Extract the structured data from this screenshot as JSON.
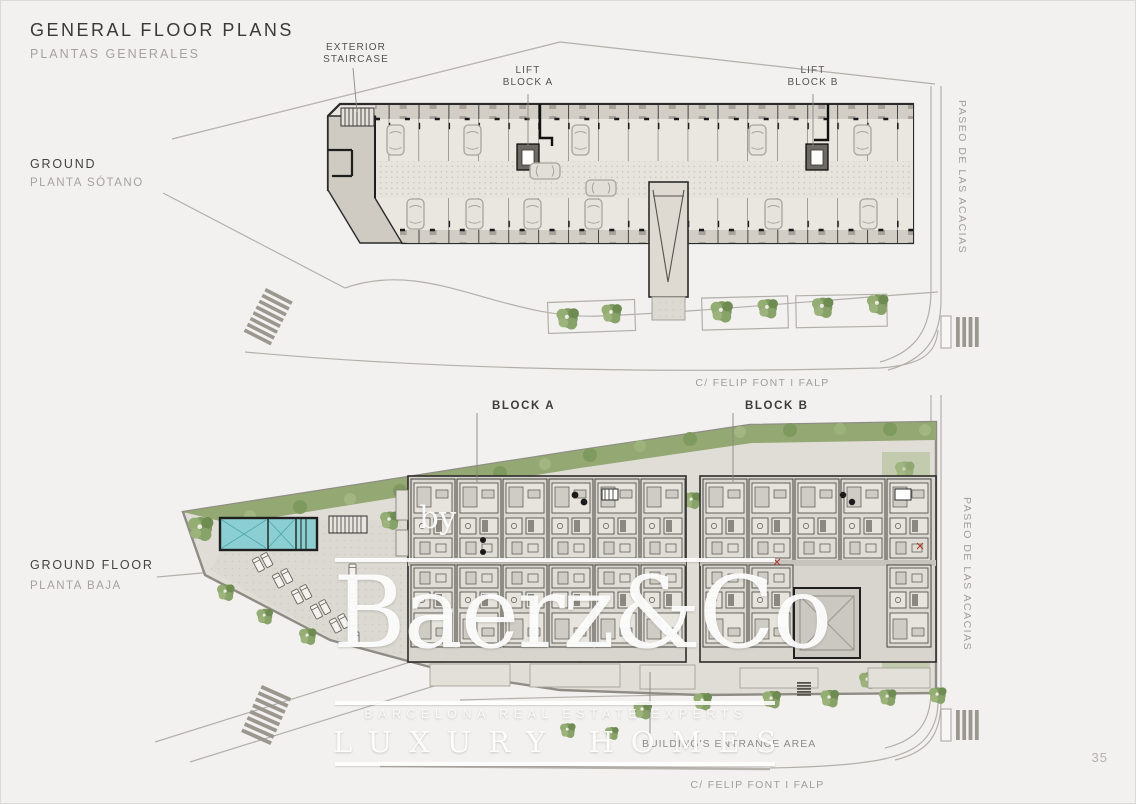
{
  "header": {
    "title": "GENERAL FLOOR PLANS",
    "subtitle": "PLANTAS GENERALES"
  },
  "page_number": "35",
  "basement_plan": {
    "name": "GROUND",
    "name_es": "PLANTA SÓTANO",
    "annotations": {
      "exterior_staircase": {
        "line1": "EXTERIOR",
        "line2": "STAIRCASE"
      },
      "lift_a": {
        "line1": "LIFT",
        "line2": "BLOCK A"
      },
      "lift_b": {
        "line1": "LIFT",
        "line2": "BLOCK B"
      }
    },
    "streets": {
      "side": "PASEO DE LAS ACACIAS",
      "bottom": "C/ FELIP FONT I FALP"
    }
  },
  "ground_plan": {
    "name": "GROUND FLOOR",
    "name_es": "PLANTA BAJA",
    "annotations": {
      "block_a": "BLOCK A",
      "block_b": "BLOCK B",
      "entrance": "BUILDING'S ENTRANCE AREA"
    },
    "streets": {
      "side": "PASEO DE LAS ACACIAS",
      "bottom": "C/ FELIP FONT I FALP"
    }
  },
  "watermark": {
    "by": "by",
    "brand": "Baerz&Co",
    "tagline": "BARCELONA REAL ESTATE EXPERTS",
    "subbrand": "LUXURY HOMES"
  },
  "colors": {
    "background": "#f2f1ef",
    "ink": "#3b3935",
    "muted": "#a5a29d",
    "wall": "#2b2b2b",
    "road": "#b3b0aa",
    "green": "#8ba46d",
    "pool": "#8ccfd2",
    "watermark": "#ffffff"
  }
}
